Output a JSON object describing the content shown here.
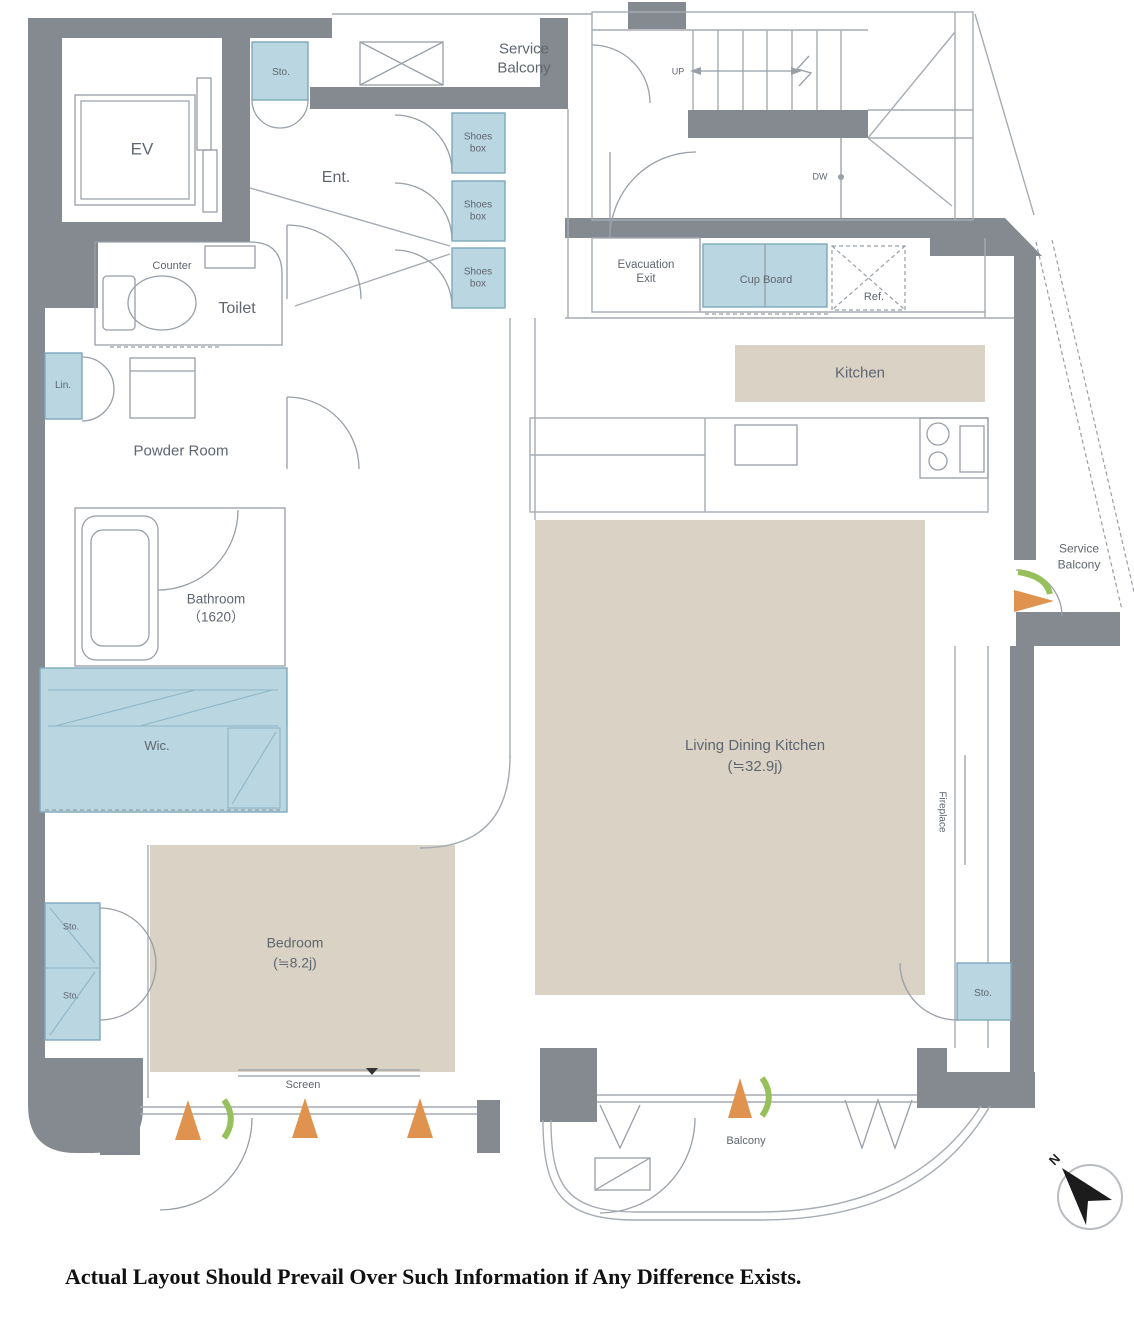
{
  "colors": {
    "wall": "#858a91",
    "blue": "#b9d6e1",
    "beige": "#d9d2c5",
    "line": "#a6acb3",
    "ink": "#5f666f",
    "orange": "#e0924f",
    "green": "#97c05c"
  },
  "rooms": {
    "service_balcony_top": "Service\nBalcony",
    "sto_top": "Sto.",
    "ev": "EV",
    "ent": "Ent.",
    "shoes_box_1": "Shoes\nbox",
    "shoes_box_2": "Shoes\nbox",
    "shoes_box_3": "Shoes\nbox",
    "evacuation_exit": "Evacuation\nExit",
    "cup_board": "Cup Board",
    "ref": "Ref.",
    "kitchen": "Kitchen",
    "counter": "Counter",
    "toilet": "Toilet",
    "lin": "Lin.",
    "powder_room": "Powder Room",
    "bathroom": "Bathroom\n（1620）",
    "wic": "Wic.",
    "service_balcony_right": "Service\nBalcony",
    "living_dining_kitchen": "Living Dining Kitchen\n(≒32.9j)",
    "fireplace": "Fireplace",
    "bedroom": "Bedroom\n(≒8.2j)",
    "sto_left_upper": "Sto.",
    "sto_left_lower": "Sto.",
    "screen": "Screen",
    "balcony": "Balcony",
    "sto_bottom_right": "Sto."
  },
  "stairs": {
    "up": "UP",
    "down": "DW"
  },
  "compass": {
    "north": "N"
  },
  "footer": {
    "disclaimer": "Actual Layout Should Prevail Over Such Information if Any Difference Exists."
  }
}
